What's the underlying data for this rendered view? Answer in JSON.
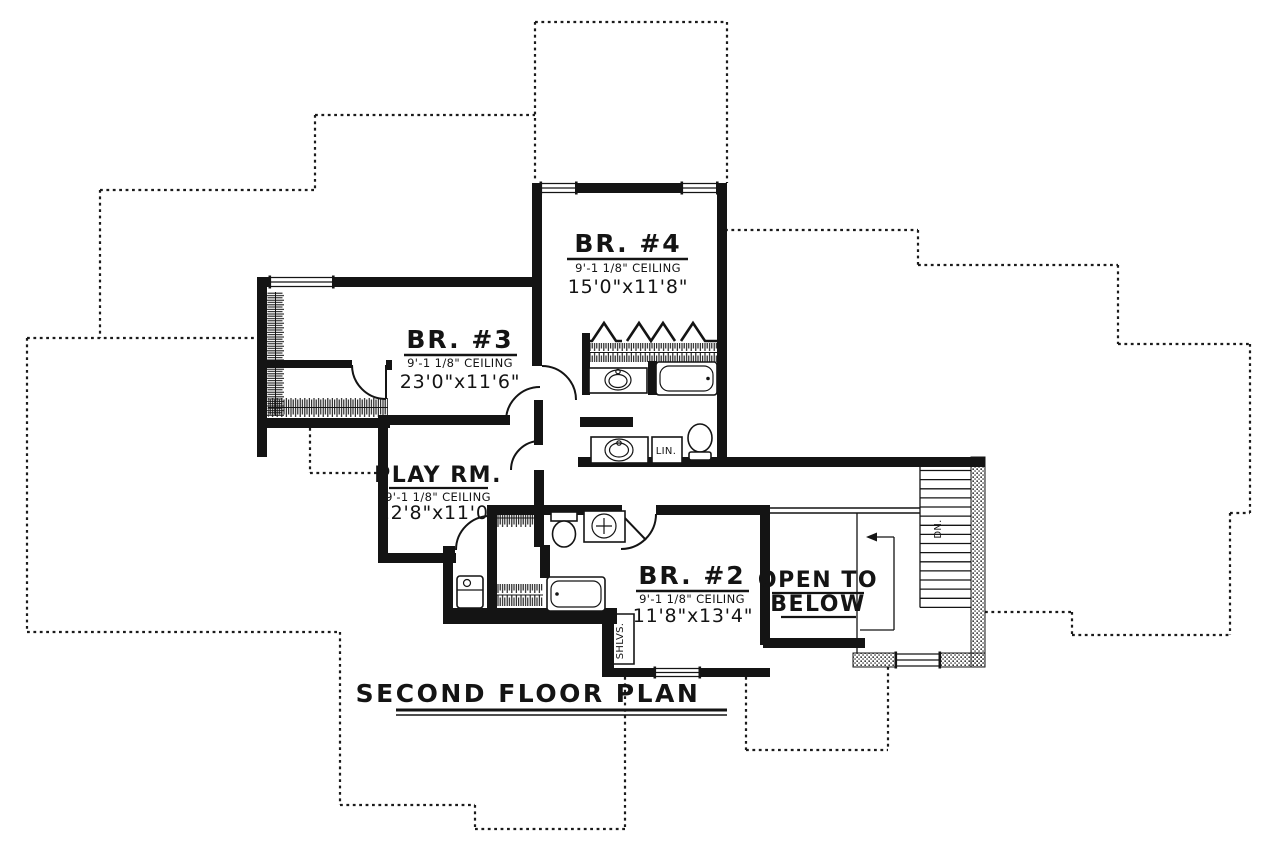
{
  "plan": {
    "title": "SECOND FLOOR PLAN",
    "rooms": {
      "br4": {
        "name": "BR. #4",
        "ceiling": "9'-1 1/8\" CEILING",
        "dims": "15'0\"x11'8\""
      },
      "br3": {
        "name": "BR. #3",
        "ceiling": "9'-1 1/8\" CEILING",
        "dims": "23'0\"x11'6\""
      },
      "play": {
        "name": "PLAY RM.",
        "ceiling": "9'-1 1/8\" CEILING",
        "dims": "12'8\"x11'0\""
      },
      "br2": {
        "name": "BR. #2",
        "ceiling": "9'-1 1/8\" CEILING",
        "dims": "11'8\"x13'4\""
      },
      "open_below": {
        "line1": "OPEN TO",
        "line2": "BELOW"
      }
    },
    "labels": {
      "linen": "LIN.",
      "down": "DN.",
      "shelves": "SHLVS."
    },
    "colors": {
      "ink": "#141414",
      "paper": "#ffffff"
    }
  }
}
